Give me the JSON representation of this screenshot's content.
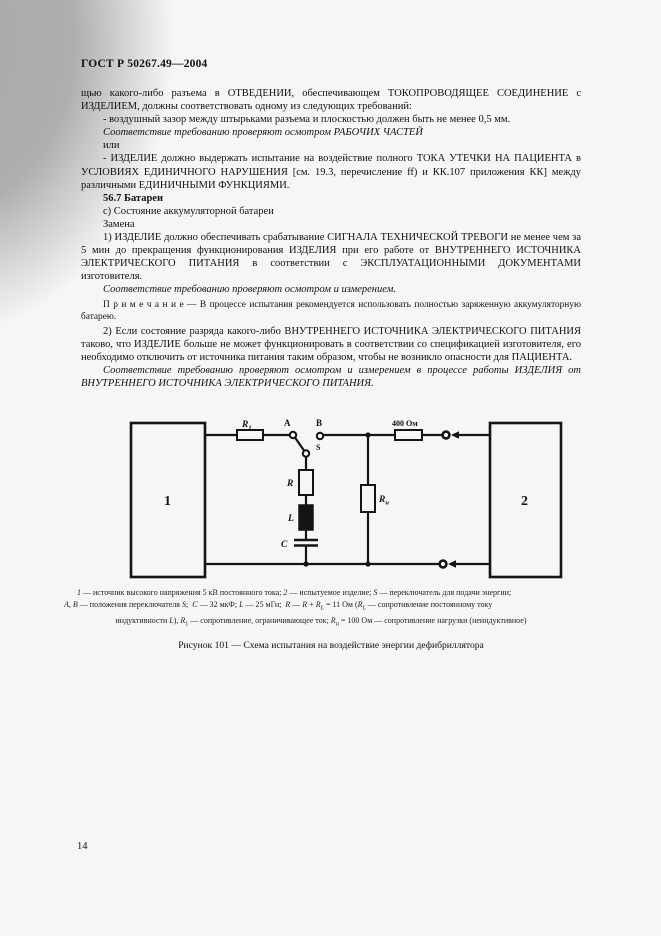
{
  "page": {
    "header": "ГОСТ Р 50267.49—2004",
    "page_number": "14"
  },
  "body": {
    "paragraphs": [
      {
        "style": "normal",
        "indent": false,
        "text": "щью какого-либо разъема в ОТВЕДЕНИИ, обеспечивающем ТОКОПРОВОДЯЩЕЕ СОЕДИНЕНИЕ с ИЗДЕЛИЕМ, должны соответствовать одному из следующих требований:"
      },
      {
        "style": "normal",
        "indent": true,
        "text": "- воздушный зазор между штырьками разъема и плоскостью должен быть не менее 0,5 мм."
      },
      {
        "style": "italic",
        "indent": true,
        "text": "Соответствие требованию проверяют осмотром РАБОЧИХ ЧАСТЕЙ"
      },
      {
        "style": "normal",
        "indent": true,
        "text": "или"
      },
      {
        "style": "normal",
        "indent": true,
        "text": "- ИЗДЕЛИЕ должно выдержать испытание на воздействие полного ТОКА УТЕЧКИ НА ПАЦИЕНТА в УСЛОВИЯХ ЕДИНИЧНОГО НАРУШЕНИЯ [см. 19.3, перечисление ff) и КК.107 приложения КК] между различными ЕДИНИЧНЫМИ ФУНКЦИЯМИ."
      },
      {
        "style": "bold",
        "indent": true,
        "text": "56.7 Батареи"
      },
      {
        "style": "normal",
        "indent": true,
        "text": "с) Состояние аккумуляторной батареи"
      },
      {
        "style": "normal",
        "indent": true,
        "text": "Замена"
      },
      {
        "style": "normal",
        "indent": true,
        "text": "1) ИЗДЕЛИЕ должно обеспечивать срабатывание СИГНАЛА ТЕХНИЧЕСКОЙ ТРЕВОГИ не менее чем за 5 мин до прекращения функционирования ИЗДЕЛИЯ при его работе от ВНУТРЕННЕГО ИСТОЧНИКА ЭЛЕКТРИЧЕСКОГО ПИТАНИЯ в соответствии с ЭКСПЛУАТАЦИОННЫМИ ДОКУМЕНТАМИ изготовителя."
      },
      {
        "style": "italic",
        "indent": true,
        "text": "Соответствие требованию проверяют осмотром и измерением."
      },
      {
        "style": "note",
        "indent": true,
        "text": "П р и м е ч а н и е — В процессе испытания рекомендуется использовать полностью заряженную аккумуляторную батарею."
      },
      {
        "style": "normal",
        "indent": true,
        "text": "2) Если состояние разряда какого-либо ВНУТРЕННЕГО ИСТОЧНИКА ЭЛЕКТРИЧЕСКОГО ПИТАНИЯ таково, что ИЗДЕЛИЕ больше не может функционировать в соответствии со спецификацией изготовителя, его необходимо отключить от источника питания таким образом, чтобы не возникло опасности для ПАЦИЕНТА."
      },
      {
        "style": "italic",
        "indent": true,
        "text": "Соответствие требованию проверяют осмотром и измерением в процессе работы ИЗДЕЛИЯ от ВНУТРЕННЕГО ИСТОЧНИКА ЭЛЕКТРИЧЕСКОГО ПИТАНИЯ."
      }
    ]
  },
  "figure": {
    "labels": {
      "box1": "1",
      "box2": "2",
      "r1_main": "R",
      "r1_sub": "1",
      "contact_a": "A",
      "contact_b": "B",
      "switch_s": "S",
      "resistor_r": "R",
      "inductor_l": "L",
      "capacitor_c": "C",
      "rn_main": "R",
      "rn_sub": "н",
      "r400": "400 Ом"
    },
    "legend": {
      "line1": "<i>1</i> — источник высокого напряжения 5 кВ постоянного тока; <i>2</i> — испытуемое изделие; <i>S</i> — переключатель для подачи энергии;",
      "line2": "<i>A</i>, <i>B</i> — положения переключателя <i>S</i>;&nbsp; <i>C</i> — 32 мкФ; <i>L</i> — 25 мГн;&nbsp; <i>R</i> — <i>R</i> + <i>R</i><sub><i>L</i></sub> = 11 Ом (<i>R</i><sub><i>L</i></sub> — сопротивление постоянному току",
      "line3": "индуктивности <i>L</i>), <i>R</i><sub>1</sub> — сопротивление, ограничивающее ток; <i>R</i><sub>н</sub> = 100 Ом — сопротивление нагрузки (неиндуктивное)"
    },
    "caption": "Рисунок 101 — Схема испытания на воздействие энергии дефибриллятора"
  }
}
